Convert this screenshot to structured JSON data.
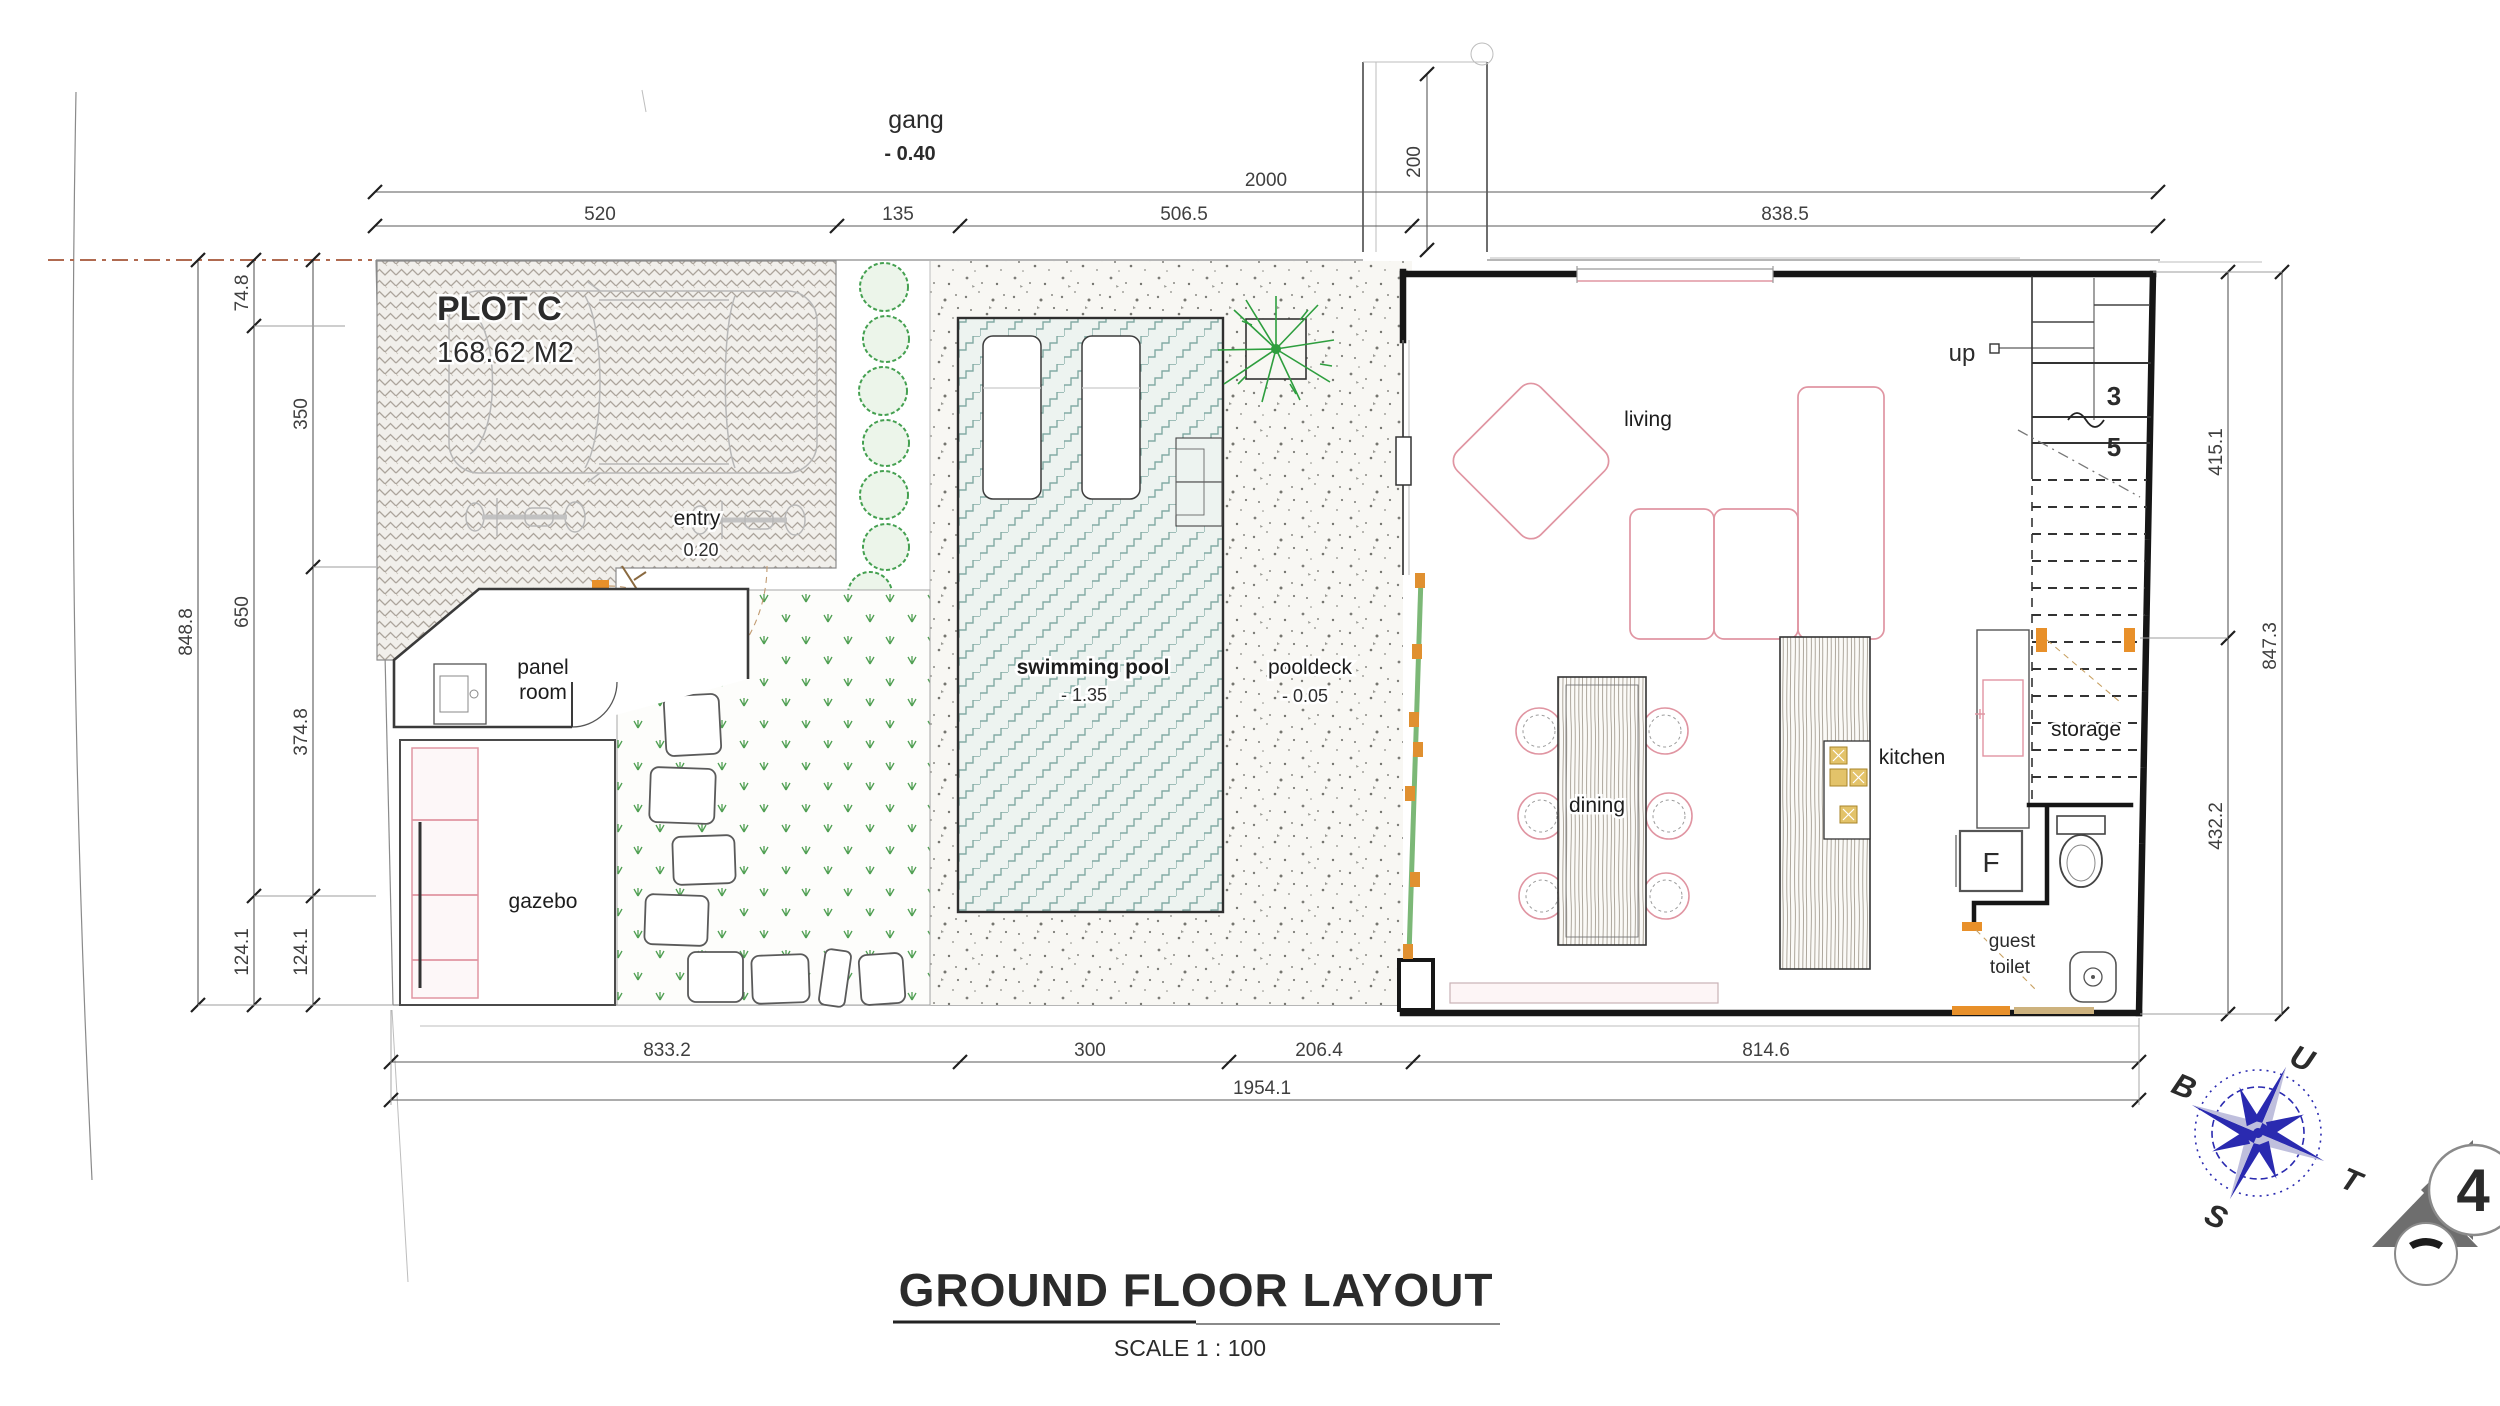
{
  "title": {
    "main": "GROUND FLOOR LAYOUT",
    "scale": "SCALE 1 : 100"
  },
  "site": {
    "plot_name": "PLOT C",
    "plot_area": "168.62 M2",
    "alley": {
      "label": "gang",
      "level": "- 0.40"
    }
  },
  "rooms": {
    "carport_entry": {
      "label": "entry",
      "level": "0.20"
    },
    "panel_room": {
      "line1": "panel",
      "line2": "room"
    },
    "gazebo": {
      "label": "gazebo"
    },
    "swimming_pool": {
      "label": "swimming pool",
      "level": "- 1.35"
    },
    "pooldeck": {
      "label": "pooldeck",
      "level": "- 0.05"
    },
    "living": {
      "label": "living"
    },
    "dining": {
      "label": "dining"
    },
    "kitchen": {
      "label": "kitchen"
    },
    "storage": {
      "label": "storage"
    },
    "guest_toilet": {
      "line1": "guest",
      "line2": "toilet"
    },
    "fridge": {
      "label": "F"
    }
  },
  "stairs": {
    "direction_label": "up",
    "tread_number_upper": "3",
    "tread_number_lower": "5"
  },
  "dimensions": {
    "top_overall": "2000",
    "top_chain": [
      "520",
      "135",
      "506.5",
      "838.5"
    ],
    "setback": "200",
    "bottom_chain": [
      "833.2",
      "300",
      "206.4",
      "814.6"
    ],
    "bottom_overall": "1954.1",
    "left_overall": "848.8",
    "left_chain_a": [
      "74.8",
      "650",
      "124.1"
    ],
    "left_chain_b": [
      "350",
      "374.8",
      "124.1"
    ],
    "right_chain": [
      "415.1",
      "432.2"
    ],
    "right_overall": "847.3"
  },
  "compass": {
    "north_label": "U",
    "east_label": "T",
    "south_label": "S",
    "west_label": "B"
  },
  "section_marker": {
    "number": "4"
  },
  "colors": {
    "compass_blue": "#2a2ab0",
    "furniture_pink": "#e095a2",
    "door_orange": "#e8902a",
    "plant_green": "#3f9e4a",
    "pool_teal": "#7fa8a2",
    "marker_gray": "#6e6e6e",
    "site_line_red": "#b06a50"
  }
}
